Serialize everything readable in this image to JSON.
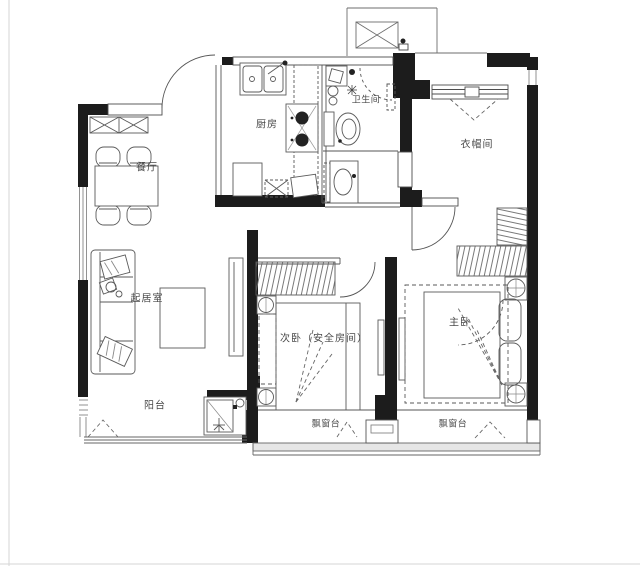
{
  "meta": {
    "drawing_type": "apartment floor plan",
    "language": "zh-CN"
  },
  "colors": {
    "wall": "#1c1c1c",
    "line": "#4d4d4d",
    "light_line": "#8a8a8a",
    "label_text": "#4a4a4a",
    "sill_fill": "#e6e6e6",
    "background": "#ffffff"
  },
  "rooms": [
    {
      "id": "dining",
      "label": "餐厅"
    },
    {
      "id": "kitchen",
      "label": "厨房"
    },
    {
      "id": "bathroom",
      "label": "卫生间"
    },
    {
      "id": "cloakroom",
      "label": "衣帽间"
    },
    {
      "id": "living",
      "label": "起居室"
    },
    {
      "id": "balcony",
      "label": "阳台"
    },
    {
      "id": "secondary-bedroom",
      "label": "次卧（安全房间）"
    },
    {
      "id": "master-bedroom",
      "label": "主卧"
    },
    {
      "id": "bay-window-left",
      "label": "飘窗台"
    },
    {
      "id": "bay-window-right",
      "label": "飘窗台"
    }
  ]
}
